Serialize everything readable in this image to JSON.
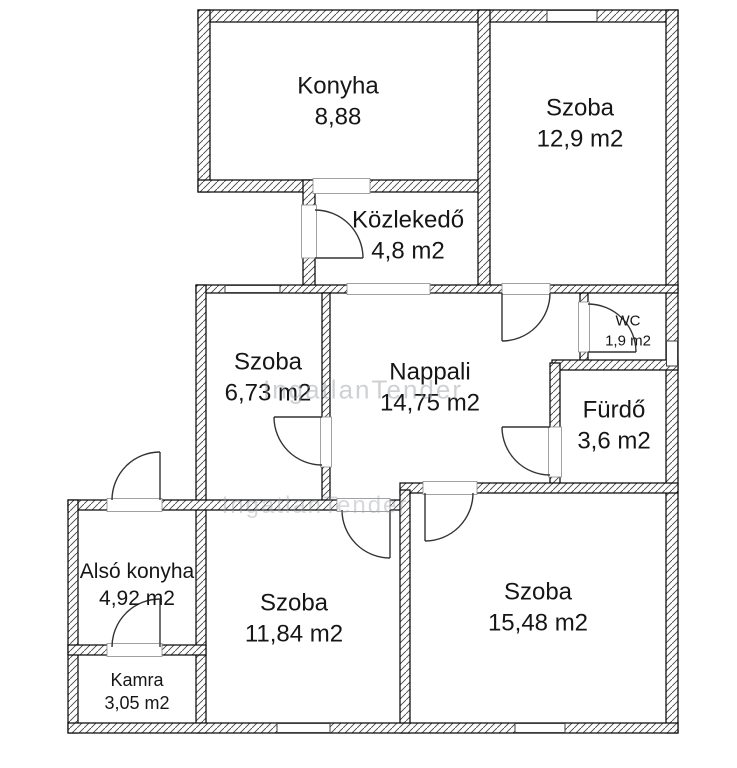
{
  "plan_title": "Apartment floor plan",
  "rooms": [
    {
      "id": "konyha",
      "name": "Konyha",
      "area": "8,88"
    },
    {
      "id": "szoba-129",
      "name": "Szoba",
      "area": "12,9 m2"
    },
    {
      "id": "kozlekedo",
      "name": "Közlekedő",
      "area": "4,8 m2"
    },
    {
      "id": "szoba-673",
      "name": "Szoba",
      "area": "6,73 m2"
    },
    {
      "id": "nappali",
      "name": "Nappali",
      "area": "14,75 m2"
    },
    {
      "id": "wc",
      "name": "WC",
      "area": "1,9 m2"
    },
    {
      "id": "furdo",
      "name": "Fürdő",
      "area": "3,6 m2"
    },
    {
      "id": "also-konyha",
      "name": "Alsó konyha",
      "area": "4,92 m2"
    },
    {
      "id": "szoba-1184",
      "name": "Szoba",
      "area": "11,84 m2"
    },
    {
      "id": "szoba-1548",
      "name": "Szoba",
      "area": "15,48 m2"
    },
    {
      "id": "kamra",
      "name": "Kamra",
      "area": "3,05 m2"
    }
  ],
  "watermark": {
    "text": "IngatlanTender"
  },
  "colors": {
    "wall_outline": "#000000",
    "hatch": "#444444",
    "door_stroke": "#333333",
    "text": "#161616",
    "watermark": "#9aa0a6"
  }
}
